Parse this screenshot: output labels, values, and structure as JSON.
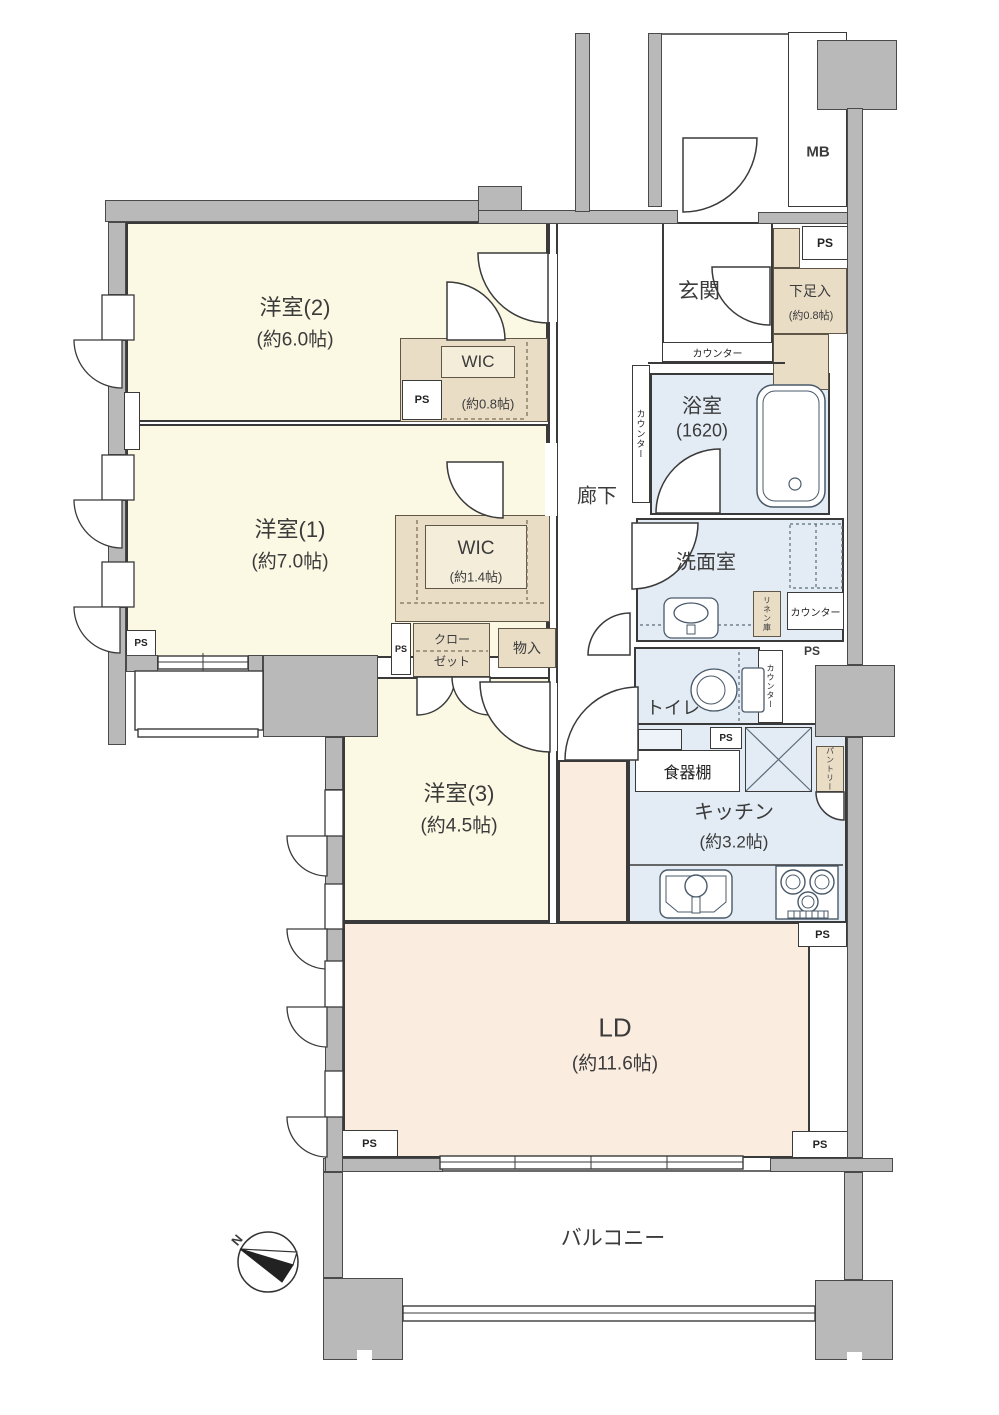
{
  "rooms": {
    "western2": {
      "name": "洋室(2)",
      "size": "(約6.0帖)"
    },
    "western1": {
      "name": "洋室(1)",
      "size": "(約7.0帖)"
    },
    "western3": {
      "name": "洋室(3)",
      "size": "(約4.5帖)"
    },
    "ld": {
      "name": "LD",
      "size": "(約11.6帖)"
    },
    "kitchen": {
      "name": "キッチン",
      "size": "(約3.2帖)"
    },
    "bathroom": {
      "name": "浴室",
      "size": "(1620)"
    },
    "washroom": "洗面室",
    "toilet": "トイレ",
    "hallway": "廊下",
    "entrance": "玄関",
    "balcony": "バルコニー"
  },
  "storage": {
    "wic_small": {
      "name": "WIC",
      "size": "(約0.8帖)"
    },
    "wic_large": {
      "name": "WIC",
      "size": "(約1.4帖)"
    },
    "closet_l1": "クロー",
    "closet_l2": "ゼット",
    "mono_ire": "物入",
    "geta": {
      "name": "下足入",
      "size": "(約0.8帖)"
    },
    "shokkidana": "食器棚",
    "pantry": "パントリー",
    "linen": "リネン庫"
  },
  "labels": {
    "ps": "PS",
    "mb": "MB",
    "counter": "カウンター",
    "north": "N"
  },
  "colors": {
    "wall_gray": "#b9b9b9",
    "room_cream": "#fbf8e3",
    "wet_blue": "#e3ecf5",
    "ld_peach": "#faecdf",
    "closet_tan": "#e9ddc6"
  }
}
